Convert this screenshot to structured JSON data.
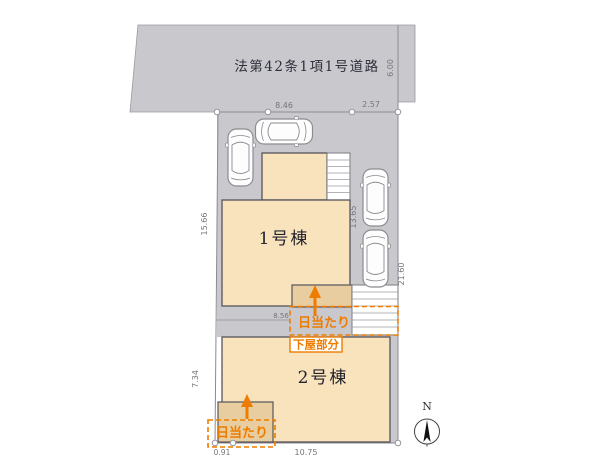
{
  "road": {
    "label": "法第42条1項1号道路"
  },
  "dimensions": {
    "frontage_left": "8.46",
    "frontage_right": "2.57",
    "road_width": "6.00",
    "left_upper": "15.66",
    "left_lower": "7.34",
    "right_depth": "21.60",
    "parking_depth": "13.65",
    "middle_width": "8.56",
    "bottom_left": "0.91",
    "bottom_width": "10.75"
  },
  "buildings": {
    "b1": {
      "label": "1号棟"
    },
    "b2": {
      "label": "2号棟"
    }
  },
  "annotations": {
    "sunlight_1": "日当たり",
    "sunlight_2": "日当たり",
    "lower_roof": "下屋部分"
  },
  "compass": {
    "north": "N"
  },
  "colors": {
    "road": "#c9c9cd",
    "driveway": "#c9c9cd",
    "building": "#f8e3bc",
    "building_shaded": "#e8cda0",
    "stairs": "#ffffff",
    "accent_orange": "#ee7c00",
    "dim_text": "#74747c",
    "label_text": "#23232e",
    "outline": "#55555c",
    "boundary": "#8a8a92"
  }
}
